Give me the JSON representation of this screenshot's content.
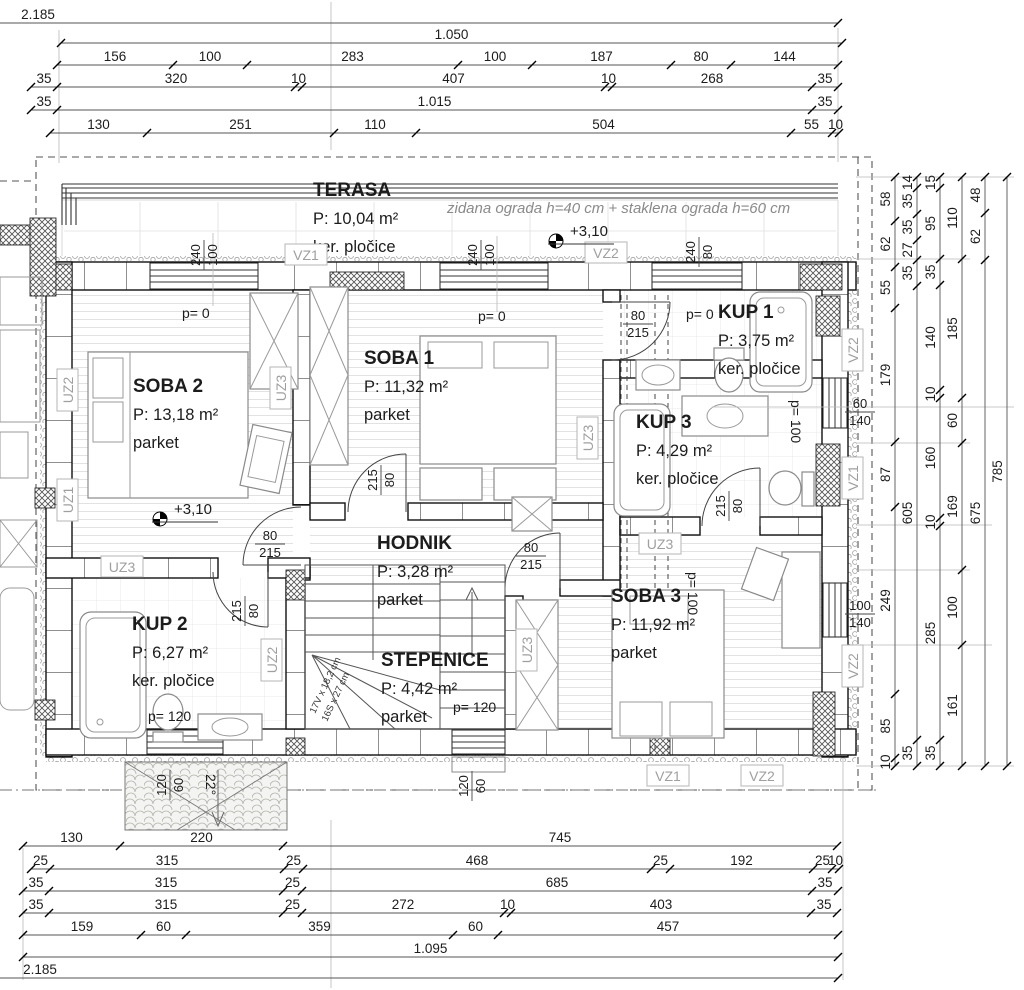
{
  "rooms": [
    {
      "name": "TERASA",
      "area": "P: 10,04 m²",
      "floor": "ker. pločice",
      "x": 313,
      "y": 196
    },
    {
      "name": "SOBA 2",
      "area": "P: 13,18 m²",
      "floor": "parket",
      "x": 133,
      "y": 392
    },
    {
      "name": "SOBA 1",
      "area": "P: 11,32 m²",
      "floor": "parket",
      "x": 364,
      "y": 364
    },
    {
      "name": "KUP 1",
      "area": "P: 3,75 m²",
      "floor": "ker. pločice",
      "x": 718,
      "y": 318
    },
    {
      "name": "KUP 3",
      "area": "P: 4,29 m²",
      "floor": "ker. pločice",
      "x": 636,
      "y": 428
    },
    {
      "name": "HODNIK",
      "area": "P: 3,28 m²",
      "floor": "parket",
      "x": 377,
      "y": 549
    },
    {
      "name": "STEPENICE",
      "area": "P: 4,42 m²",
      "floor": "parket",
      "x": 381,
      "y": 666
    },
    {
      "name": "KUP 2",
      "area": "P: 6,27 m²",
      "floor": "ker. pločice",
      "x": 132,
      "y": 630
    },
    {
      "name": "SOBA 3",
      "area": "P: 11,92 m²",
      "floor": "parket",
      "x": 611,
      "y": 602
    }
  ],
  "texts": [
    {
      "t": "zidana ograda h=40 cm + staklena ograda h=60 cm",
      "x": 447,
      "y": 213,
      "cls": "note"
    },
    {
      "t": "p= 0",
      "x": 182,
      "y": 318,
      "cls": "p"
    },
    {
      "t": "p= 0",
      "x": 478,
      "y": 321,
      "cls": "p"
    },
    {
      "t": "p= 0",
      "x": 686,
      "y": 319,
      "cls": "p"
    },
    {
      "t": "p= 100",
      "x": 791,
      "y": 400,
      "r": 90,
      "cls": "p"
    },
    {
      "t": "p= 100",
      "x": 688,
      "y": 572,
      "r": 90,
      "cls": "p"
    },
    {
      "t": "p= 120",
      "x": 453,
      "y": 712,
      "cls": "p"
    },
    {
      "t": "p= 120",
      "x": 148,
      "y": 721,
      "cls": "p"
    },
    {
      "t": "22°",
      "x": 206,
      "y": 774,
      "r": 90,
      "cls": "deg"
    },
    {
      "t": "17V x 18,2 cm",
      "x": 315,
      "y": 714,
      "r": -65,
      "cls": "stairtxt"
    },
    {
      "t": "16S x 27 cm",
      "x": 327,
      "y": 722,
      "r": -65,
      "cls": "stairtxt"
    }
  ],
  "level_markers": [
    {
      "t": "+3,10",
      "x": 556,
      "y": 241
    },
    {
      "t": "+3,10",
      "x": 160,
      "y": 519
    }
  ],
  "wall_labels": [
    {
      "t": "VZ1",
      "x": 306,
      "y": 255,
      "r": 0
    },
    {
      "t": "VZ2",
      "x": 606,
      "y": 253,
      "r": 0
    },
    {
      "t": "VZ2",
      "x": 853,
      "y": 350,
      "r": -90
    },
    {
      "t": "VZ1",
      "x": 853,
      "y": 478,
      "r": -90
    },
    {
      "t": "VZ2",
      "x": 853,
      "y": 666,
      "r": -90
    },
    {
      "t": "VZ1",
      "x": 668,
      "y": 776,
      "r": 0
    },
    {
      "t": "VZ2",
      "x": 762,
      "y": 776,
      "r": 0
    },
    {
      "t": "UZ2",
      "x": 68,
      "y": 390,
      "r": -90
    },
    {
      "t": "UZ1",
      "x": 68,
      "y": 500,
      "r": -90
    },
    {
      "t": "UZ3",
      "x": 122,
      "y": 567,
      "r": 0
    },
    {
      "t": "UZ2",
      "x": 272,
      "y": 660,
      "r": -90
    },
    {
      "t": "UZ3",
      "x": 281,
      "y": 388,
      "r": -90
    },
    {
      "t": "UZ3",
      "x": 588,
      "y": 438,
      "r": -90
    },
    {
      "t": "UZ3",
      "x": 660,
      "y": 544,
      "r": 0
    },
    {
      "t": "UZ3",
      "x": 527,
      "y": 650,
      "r": -90
    }
  ],
  "dim_pairs": [
    {
      "x": 204,
      "y": 255,
      "r": -90,
      "a": "240",
      "b": "100"
    },
    {
      "x": 481,
      "y": 255,
      "r": -90,
      "a": "240",
      "b": "100"
    },
    {
      "x": 699,
      "y": 252,
      "r": -90,
      "a": "240",
      "b": "80"
    },
    {
      "x": 860,
      "y": 412,
      "r": 0,
      "a": "60",
      "b": "140"
    },
    {
      "x": 860,
      "y": 614,
      "r": 0,
      "a": "100",
      "b": "140"
    },
    {
      "x": 170,
      "y": 785,
      "r": -90,
      "a": "120",
      "b": "60"
    },
    {
      "x": 472,
      "y": 786,
      "r": -90,
      "a": "120",
      "b": "60"
    },
    {
      "x": 270,
      "y": 544,
      "r": 0,
      "a": "80",
      "b": "215"
    },
    {
      "x": 381,
      "y": 480,
      "r": -90,
      "a": "215",
      "b": "80"
    },
    {
      "x": 638,
      "y": 324,
      "r": 0,
      "a": "80",
      "b": "215"
    },
    {
      "x": 531,
      "y": 556,
      "r": 0,
      "a": "80",
      "b": "215"
    },
    {
      "x": 729,
      "y": 506,
      "r": -90,
      "a": "215",
      "b": "80"
    },
    {
      "x": 245,
      "y": 611,
      "r": -90,
      "a": "215",
      "b": "80"
    }
  ],
  "dims": {
    "h": [
      {
        "y": 23,
        "x0": -8,
        "segs": [
          [
            "2.185",
            846,
            38
          ]
        ]
      },
      {
        "y": 43,
        "x0": 61,
        "segs": [
          [
            "1.050",
            781
          ]
        ]
      },
      {
        "y": 65,
        "x0": 57,
        "segs": [
          [
            "156",
            116
          ],
          [
            "100",
            74
          ],
          [
            "283",
            211
          ],
          [
            "100",
            74
          ],
          [
            "187",
            139
          ],
          [
            "80",
            60
          ],
          [
            "144",
            107
          ]
        ]
      },
      {
        "y": 87,
        "x0": 31,
        "segs": [
          [
            "35",
            26
          ],
          [
            "320",
            238
          ],
          [
            "10",
            7
          ],
          [
            "407",
            303
          ],
          [
            "10",
            7
          ],
          [
            "268",
            200
          ],
          [
            "35",
            26
          ]
        ]
      },
      {
        "y": 110,
        "x0": 31,
        "segs": [
          [
            "35",
            26
          ],
          [
            "1.015",
            755
          ],
          [
            "35",
            26
          ]
        ]
      },
      {
        "y": 133,
        "x0": 50,
        "segs": [
          [
            "130",
            97
          ],
          [
            "251",
            187
          ],
          [
            "110",
            82
          ],
          [
            "504",
            375
          ],
          [
            "55",
            41
          ],
          [
            "10",
            7
          ]
        ]
      },
      {
        "y": 846,
        "x0": 23,
        "segs": [
          [
            "130",
            97
          ],
          [
            "220",
            163
          ],
          [
            "745",
            554
          ]
        ]
      },
      {
        "y": 869,
        "x0": 31,
        "segs": [
          [
            "25",
            19
          ],
          [
            "315",
            234
          ],
          [
            "25",
            19
          ],
          [
            "468",
            348
          ],
          [
            "25",
            19
          ],
          [
            "192",
            143
          ],
          [
            "25",
            19
          ],
          [
            "10",
            7
          ]
        ]
      },
      {
        "y": 891,
        "x0": 23,
        "segs": [
          [
            "35",
            26
          ],
          [
            "315",
            234
          ],
          [
            "25",
            19
          ],
          [
            "685",
            510
          ],
          [
            "35",
            26
          ]
        ]
      },
      {
        "y": 913,
        "x0": 23,
        "segs": [
          [
            "35",
            26
          ],
          [
            "315",
            234
          ],
          [
            "25",
            19
          ],
          [
            "272",
            202
          ],
          [
            "10",
            7
          ],
          [
            "403",
            300
          ],
          [
            "35",
            26
          ]
        ]
      },
      {
        "y": 935,
        "x0": 23,
        "segs": [
          [
            "159",
            118
          ],
          [
            "60",
            45
          ],
          [
            "359",
            267
          ],
          [
            "60",
            45
          ],
          [
            "457",
            340
          ]
        ]
      },
      {
        "y": 957,
        "x0": 23,
        "segs": [
          [
            "1.095",
            815
          ]
        ]
      },
      {
        "y": 978,
        "x0": -8,
        "segs": [
          [
            "2.185",
            846,
            40
          ]
        ]
      }
    ],
    "v": [
      {
        "x": 895,
        "y0": 177,
        "segs": [
          [
            "58",
            44
          ],
          [
            "62",
            46
          ],
          [
            "55",
            41
          ],
          [
            "179",
            134
          ],
          [
            "87",
            65
          ],
          [
            "249",
            187
          ],
          [
            "85",
            64
          ],
          [
            "10",
            8
          ]
        ]
      },
      {
        "x": 917,
        "y0": 177,
        "segs": [
          [
            "14",
            11
          ],
          [
            "35",
            26
          ],
          [
            "35",
            26
          ],
          [
            "27",
            20
          ],
          [
            "35",
            26
          ],
          [
            "605",
            454
          ],
          [
            "35",
            26
          ]
        ]
      },
      {
        "x": 940,
        "y0": 177,
        "segs": [
          [
            "15",
            11
          ],
          [
            "95",
            71
          ],
          [
            "35",
            26
          ],
          [
            "140",
            105
          ],
          [
            "10",
            8
          ],
          [
            "160",
            120
          ],
          [
            "10",
            8
          ],
          [
            "285",
            214
          ],
          [
            "35",
            26
          ]
        ]
      },
      {
        "x": 962,
        "y0": 177,
        "segs": [
          [
            "110",
            82
          ],
          [
            "185",
            139
          ],
          [
            "60",
            45
          ],
          [
            "169",
            127
          ],
          [
            "100",
            75
          ],
          [
            "161",
            121
          ]
        ]
      },
      {
        "x": 985,
        "y0": 177,
        "segs": [
          [
            "48",
            36
          ],
          [
            "62",
            47
          ],
          [
            "675",
            506
          ]
        ]
      },
      {
        "x": 1007,
        "y0": 177,
        "segs": [
          [
            "785",
            589
          ]
        ]
      }
    ]
  }
}
